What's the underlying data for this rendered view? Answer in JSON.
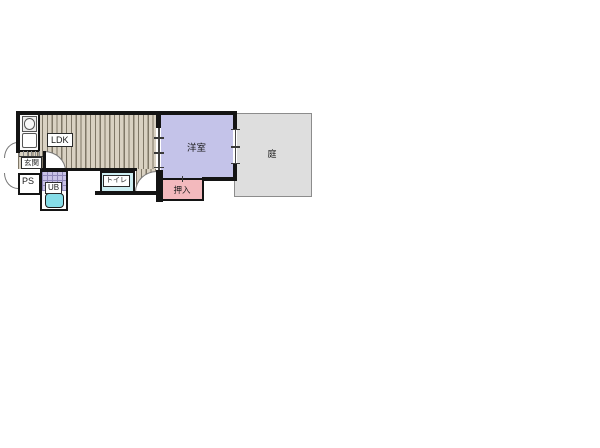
{
  "floorplan": {
    "rooms": {
      "ldk": {
        "label": "LDK"
      },
      "genkan": {
        "label": "玄関"
      },
      "ps": {
        "label": "PS"
      },
      "ub": {
        "label": "UB"
      },
      "toilet": {
        "label": "トイレ"
      },
      "western_room": {
        "label": "洋室"
      },
      "oshiire": {
        "label": "押入"
      },
      "garden": {
        "label": "庭"
      }
    },
    "colors": {
      "wall": "#141414",
      "ldk_floor_base": "#d9d1c2",
      "ldk_floor_stripe": "#7f7767",
      "western_room_fill": "#c4c3e9",
      "oshiire_fill": "#f3b9bd",
      "garden_fill": "#dedede",
      "garden_border": "#8c8c8c",
      "toilet_fill": "#cdeef2",
      "bathtub_fill": "#86dde8",
      "ub_tile_fill": "#c9c2e6"
    }
  }
}
